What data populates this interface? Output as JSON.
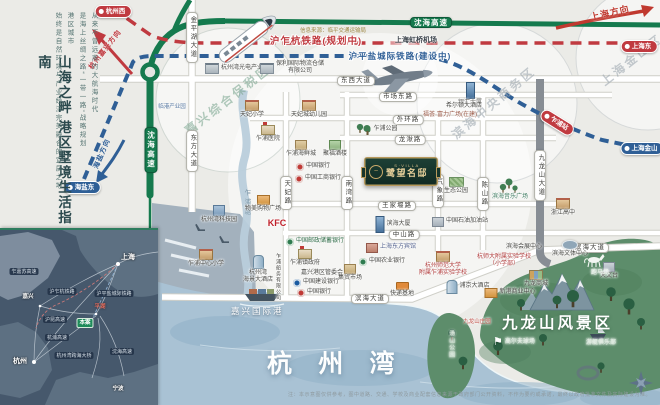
{
  "sidebar": {
    "title": "山海之畔  港区墅境生活指南",
    "intro_columns": [
      "从来不曾远离的大航海时代",
      "是海上丝绸之路“一带一路”战略规划",
      "港区城市",
      "始终是自然环境与产业经济完美融合的宜居之地"
    ]
  },
  "plaque": {
    "en": "S·VILLA",
    "name": "鹭望名邸",
    "logo": "swan-monogram"
  },
  "big_labels": {
    "bay": "杭 州 湾",
    "scenic": "九龙山风景区",
    "port": "嘉兴国际港"
  },
  "source_note": "信息来源：临平交通运输局",
  "disclaimer": "注：本示意图仅供参考，图中道路、交通、学校及商业配套信息来源于政府部门公开资料，不作为要约或承诺，最终以政府批准文件及实际建设为准。",
  "colors": {
    "highway_green": "#157a4e",
    "rail_red": "#c03a40",
    "rail_blue": "#2f5f96",
    "sea": "#a9c2d4",
    "scenic_green": "#5d8d6b",
    "plaque_gold": "#c9a96a"
  },
  "rail_labels": [
    {
      "t": "沪乍杭铁路(规划中)",
      "x": 316,
      "y": 36,
      "c": "#c03a40",
      "s": 9.5
    },
    {
      "t": "沪平盐城际铁路(建设中)",
      "x": 400,
      "y": 51,
      "c": "#2f5f96",
      "s": 8.5
    }
  ],
  "arrows": [
    {
      "t": "杭州嘉兴方向",
      "x": 106,
      "y": 46,
      "rot": -52,
      "c": "#c03a40",
      "s": 7
    },
    {
      "t": "上海方向",
      "x": 610,
      "y": 8,
      "rot": -13,
      "c": "#c0392f",
      "s": 9
    },
    {
      "t": "海盐方向",
      "x": 103,
      "y": 150,
      "rot": -67,
      "c": "#2f5f96",
      "s": 7
    }
  ],
  "stations": [
    {
      "t": "杭州西",
      "x": 113,
      "y": 5,
      "kind": "red"
    },
    {
      "t": "上海东",
      "x": 639,
      "y": 40,
      "kind": "red"
    },
    {
      "t": "海盐东",
      "x": 82,
      "y": 181,
      "kind": "blue"
    },
    {
      "t": "上海金山",
      "x": 642,
      "y": 142,
      "kind": "blue"
    },
    {
      "t": "乍浦站",
      "x": 557,
      "y": 116,
      "kind": "red",
      "rot": 32
    }
  ],
  "green_pills": [
    {
      "t": "沈海高速",
      "x": 431,
      "y": 17
    },
    {
      "t": "沈海高速",
      "x": 151,
      "y": 127,
      "v": true
    }
  ],
  "road_pills": [
    {
      "t": "金平湖大道",
      "x": 192,
      "y": 12,
      "v": true
    },
    {
      "t": "东方大道",
      "x": 192,
      "y": 130,
      "v": true
    },
    {
      "t": "东西大道",
      "x": 356,
      "y": 76
    },
    {
      "t": "市场东路",
      "x": 398,
      "y": 92
    },
    {
      "t": "外环路",
      "x": 408,
      "y": 115
    },
    {
      "t": "龙湫路",
      "x": 410,
      "y": 135
    },
    {
      "t": "王家堰路",
      "x": 397,
      "y": 201
    },
    {
      "t": "中山路",
      "x": 404,
      "y": 230
    },
    {
      "t": "滨海大道",
      "x": 370,
      "y": 294
    },
    {
      "t": "滨海大道",
      "x": 590,
      "y": 243
    },
    {
      "t": "天妃路",
      "x": 286,
      "y": 176,
      "v": true
    },
    {
      "t": "南湾路",
      "x": 347,
      "y": 176,
      "v": true
    },
    {
      "t": "气象路",
      "x": 438,
      "y": 174,
      "v": true
    },
    {
      "t": "陈山路",
      "x": 483,
      "y": 177,
      "v": true
    },
    {
      "t": "九龙山大道",
      "x": 540,
      "y": 150,
      "v": true
    },
    {
      "t": "乍浦塘",
      "x": 246,
      "y": 186,
      "v": true,
      "bare": true
    }
  ],
  "watermarks": [
    {
      "t": "嘉兴综合保税区",
      "x": 228,
      "y": 100,
      "rot": -38,
      "c": "#7fa893",
      "s": 12
    },
    {
      "t": "滨海中央商务区",
      "x": 494,
      "y": 103,
      "rot": -40,
      "c": "#9fa9b1",
      "s": 12
    },
    {
      "t": "上海金山区",
      "x": 632,
      "y": 60,
      "rot": -38,
      "c": "#9fa9b1",
      "s": 12
    }
  ],
  "pois": [
    {
      "t": "杭州湾光电产业园",
      "x": 237,
      "y": 63,
      "i": "factory",
      "row": true
    },
    {
      "t": "保利国际物流仓储\n有限公司",
      "x": 292,
      "y": 61,
      "i": "factory",
      "row": true
    },
    {
      "t": "临港产业园",
      "x": 172,
      "y": 104,
      "c": "#5577a0",
      "s": 5.5
    },
    {
      "t": "天妃小学",
      "x": 252,
      "y": 100,
      "i": "school"
    },
    {
      "t": "天妃城幼儿园",
      "x": 309,
      "y": 100,
      "i": "school"
    },
    {
      "t": "乍浦公园",
      "x": 380,
      "y": 125,
      "i": "tree",
      "row": true
    },
    {
      "t": "银汇大厦",
      "x": 470,
      "y": 82,
      "i": "tower"
    },
    {
      "t": "希尔顿大酒店",
      "x": 464,
      "y": 103
    },
    {
      "t": "福荟·富力广场(在建)",
      "x": 450,
      "y": 112,
      "c": "#9a5a48"
    },
    {
      "t": "乍浦医院",
      "x": 268,
      "y": 125,
      "i": "gov"
    },
    {
      "t": "乍浦海鲜城",
      "x": 301,
      "y": 140,
      "i": "bt"
    },
    {
      "t": "聚福酒楼",
      "x": 335,
      "y": 140,
      "i": "bg2"
    },
    {
      "t": "中国银行",
      "x": 313,
      "y": 163,
      "i": "bkr",
      "row": true
    },
    {
      "t": "中国工商银行",
      "x": 318,
      "y": 175,
      "i": "bkr",
      "row": true
    },
    {
      "t": "杭州湾科技园",
      "x": 219,
      "y": 205,
      "i": "bb"
    },
    {
      "t": "物美购物广场",
      "x": 263,
      "y": 195,
      "i": "mall"
    },
    {
      "t": "KFC",
      "x": 277,
      "y": 218,
      "c": "#c0202a",
      "s": 9,
      "b": true
    },
    {
      "t": "中国邮政储蓄银行",
      "x": 315,
      "y": 238,
      "i": "bkg",
      "row": true,
      "c": "#2e6b46"
    },
    {
      "t": "滨海大厦",
      "x": 393,
      "y": 216,
      "i": "tower",
      "row": true
    },
    {
      "t": "上海东方宾馆",
      "x": 391,
      "y": 243,
      "i": "br",
      "row": true,
      "c": "#53628f"
    },
    {
      "t": "乍浦中心小学",
      "x": 206,
      "y": 249,
      "i": "school"
    },
    {
      "t": "杭州湾\n海景大酒店",
      "x": 258,
      "y": 255,
      "i": "hotel"
    },
    {
      "t": "乍浦船务有限公司",
      "x": 278,
      "y": 253,
      "vert": true,
      "s": 5
    },
    {
      "t": "乍浦镇政府",
      "x": 305,
      "y": 249,
      "i": "gov"
    },
    {
      "t": "嘉兴港区管委会",
      "x": 322,
      "y": 270
    },
    {
      "t": "中国建设银行",
      "x": 316,
      "y": 279,
      "i": "bkb",
      "row": true
    },
    {
      "t": "中国银行",
      "x": 314,
      "y": 289,
      "i": "bkr",
      "row": true
    },
    {
      "t": "集贸市场",
      "x": 350,
      "y": 264,
      "i": "bt"
    },
    {
      "t": "中国农业银行",
      "x": 382,
      "y": 258,
      "i": "bkg",
      "row": true
    },
    {
      "t": "快递基地",
      "x": 402,
      "y": 282,
      "i": "truck"
    },
    {
      "t": "杭州师范大学\n附属乍浦实验学校",
      "x": 443,
      "y": 251,
      "i": "school",
      "c": "#b03a3a"
    },
    {
      "t": "浦京大酒店",
      "x": 468,
      "y": 280,
      "i": "hotel",
      "row": true
    },
    {
      "t": "杭师大附属实验学校\n（小学部）",
      "x": 504,
      "y": 254,
      "c": "#b03a3a"
    },
    {
      "t": "滨海会展中心",
      "x": 524,
      "y": 244
    },
    {
      "t": "九龙商城",
      "x": 536,
      "y": 270,
      "i": "bc"
    },
    {
      "t": "新港商业中心",
      "x": 510,
      "y": 288,
      "i": "mall",
      "row": true
    },
    {
      "t": "滨海音乐广场",
      "x": 510,
      "y": 194,
      "c": "#3f7d62"
    },
    {
      "t": "浙江高中",
      "x": 563,
      "y": 198,
      "i": "school"
    },
    {
      "t": "滨海文体中心",
      "x": 570,
      "y": 240,
      "i": "stad"
    },
    {
      "t": "天文台",
      "x": 609,
      "y": 262,
      "i": "bgr"
    },
    {
      "t": "生态公园",
      "x": 456,
      "y": 177,
      "i": "field"
    },
    {
      "t": "中国石油加油站",
      "x": 460,
      "y": 217,
      "i": "bgr",
      "row": true
    },
    {
      "t": "上海虹桥机场",
      "x": 416,
      "y": 37,
      "s": 7,
      "b": true,
      "c": "#3a424a"
    },
    {
      "t": "跑马场",
      "x": 600,
      "y": 270,
      "i": "horse",
      "c": "#eef6ee"
    },
    {
      "t": "高尔夫球场",
      "x": 514,
      "y": 337,
      "i": "golf",
      "row": true,
      "c": "#e4f0e4"
    },
    {
      "t": "游艇俱乐部",
      "x": 601,
      "y": 340,
      "c": "#e4f0e4"
    },
    {
      "t": "汤山公园",
      "x": 450,
      "y": 330,
      "vert": true,
      "c": "#d8e8d8"
    },
    {
      "t": "九龙山庄园",
      "x": 477,
      "y": 319,
      "c": "#c04a42",
      "s": 5.5
    }
  ],
  "inset": {
    "cities": [
      {
        "t": "上海",
        "x": 128,
        "y": 24,
        "s": 7
      },
      {
        "t": "杭州",
        "x": 20,
        "y": 128,
        "s": 7
      },
      {
        "t": "嘉兴",
        "x": 28,
        "y": 64,
        "s": 5.5
      },
      {
        "t": "宁波",
        "x": 118,
        "y": 156,
        "s": 5.5
      }
    ],
    "pills": [
      {
        "t": "乍嘉苏高速",
        "x": 24,
        "y": 38
      },
      {
        "t": "沪乍杭铁路",
        "x": 62,
        "y": 58
      },
      {
        "t": "沪平盐城际铁路",
        "x": 114,
        "y": 60
      },
      {
        "t": "沪昆高速",
        "x": 55,
        "y": 86
      },
      {
        "t": "杭浦高速",
        "x": 57,
        "y": 104
      },
      {
        "t": "杭州湾跨海大桥",
        "x": 74,
        "y": 122
      },
      {
        "t": "沈海高速",
        "x": 122,
        "y": 118
      }
    ],
    "site": {
      "t": "本案",
      "x": 85,
      "y": 88
    },
    "pinghu": {
      "t": "平湖",
      "x": 100,
      "y": 74
    }
  }
}
